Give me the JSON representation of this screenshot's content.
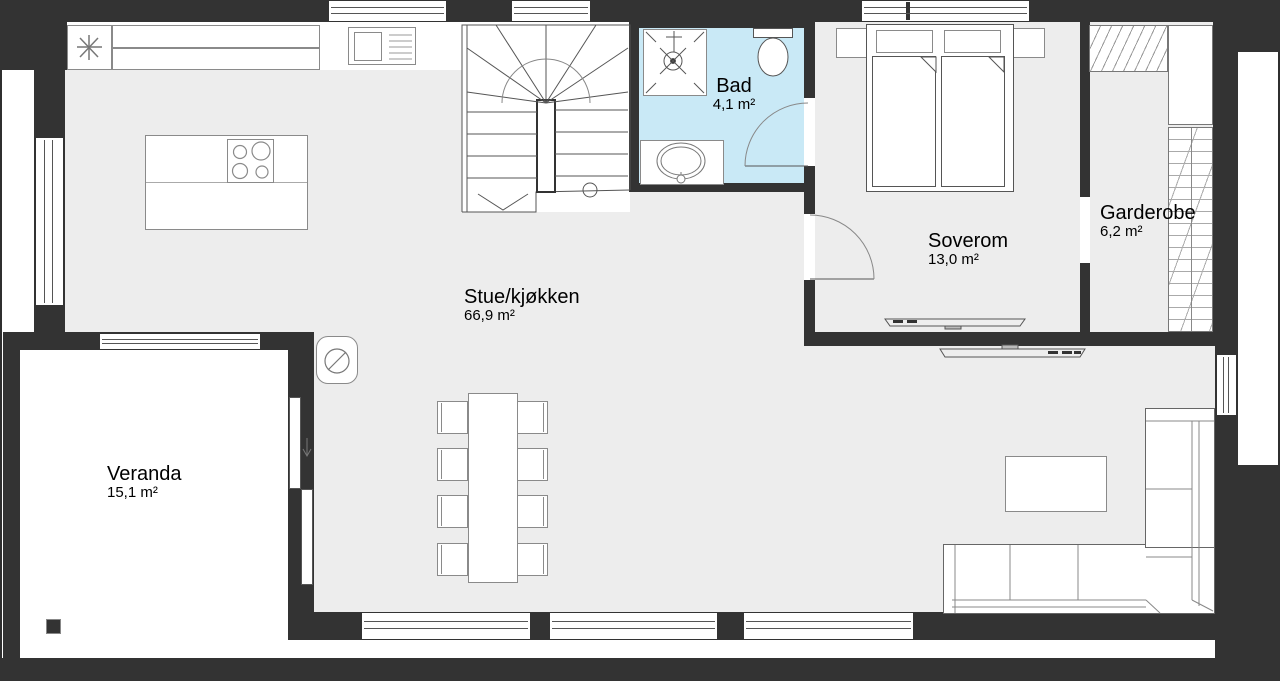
{
  "plan": {
    "type": "floor-plan",
    "language": "norwegian"
  },
  "colors": {
    "wall": "#333333",
    "floor": "#ededed",
    "bath": "#c9e9f6",
    "outline": "#8a8a8a"
  },
  "rooms": {
    "stue": {
      "name": "Stue/kjøkken",
      "area": "66,9 m²"
    },
    "bad": {
      "name": "Bad",
      "area": "4,1 m²"
    },
    "soverom": {
      "name": "Soverom",
      "area": "13,0 m²"
    },
    "garderobe": {
      "name": "Garderobe",
      "area": "6,2 m²"
    },
    "veranda": {
      "name": "Veranda",
      "area": "15,1 m²"
    }
  }
}
